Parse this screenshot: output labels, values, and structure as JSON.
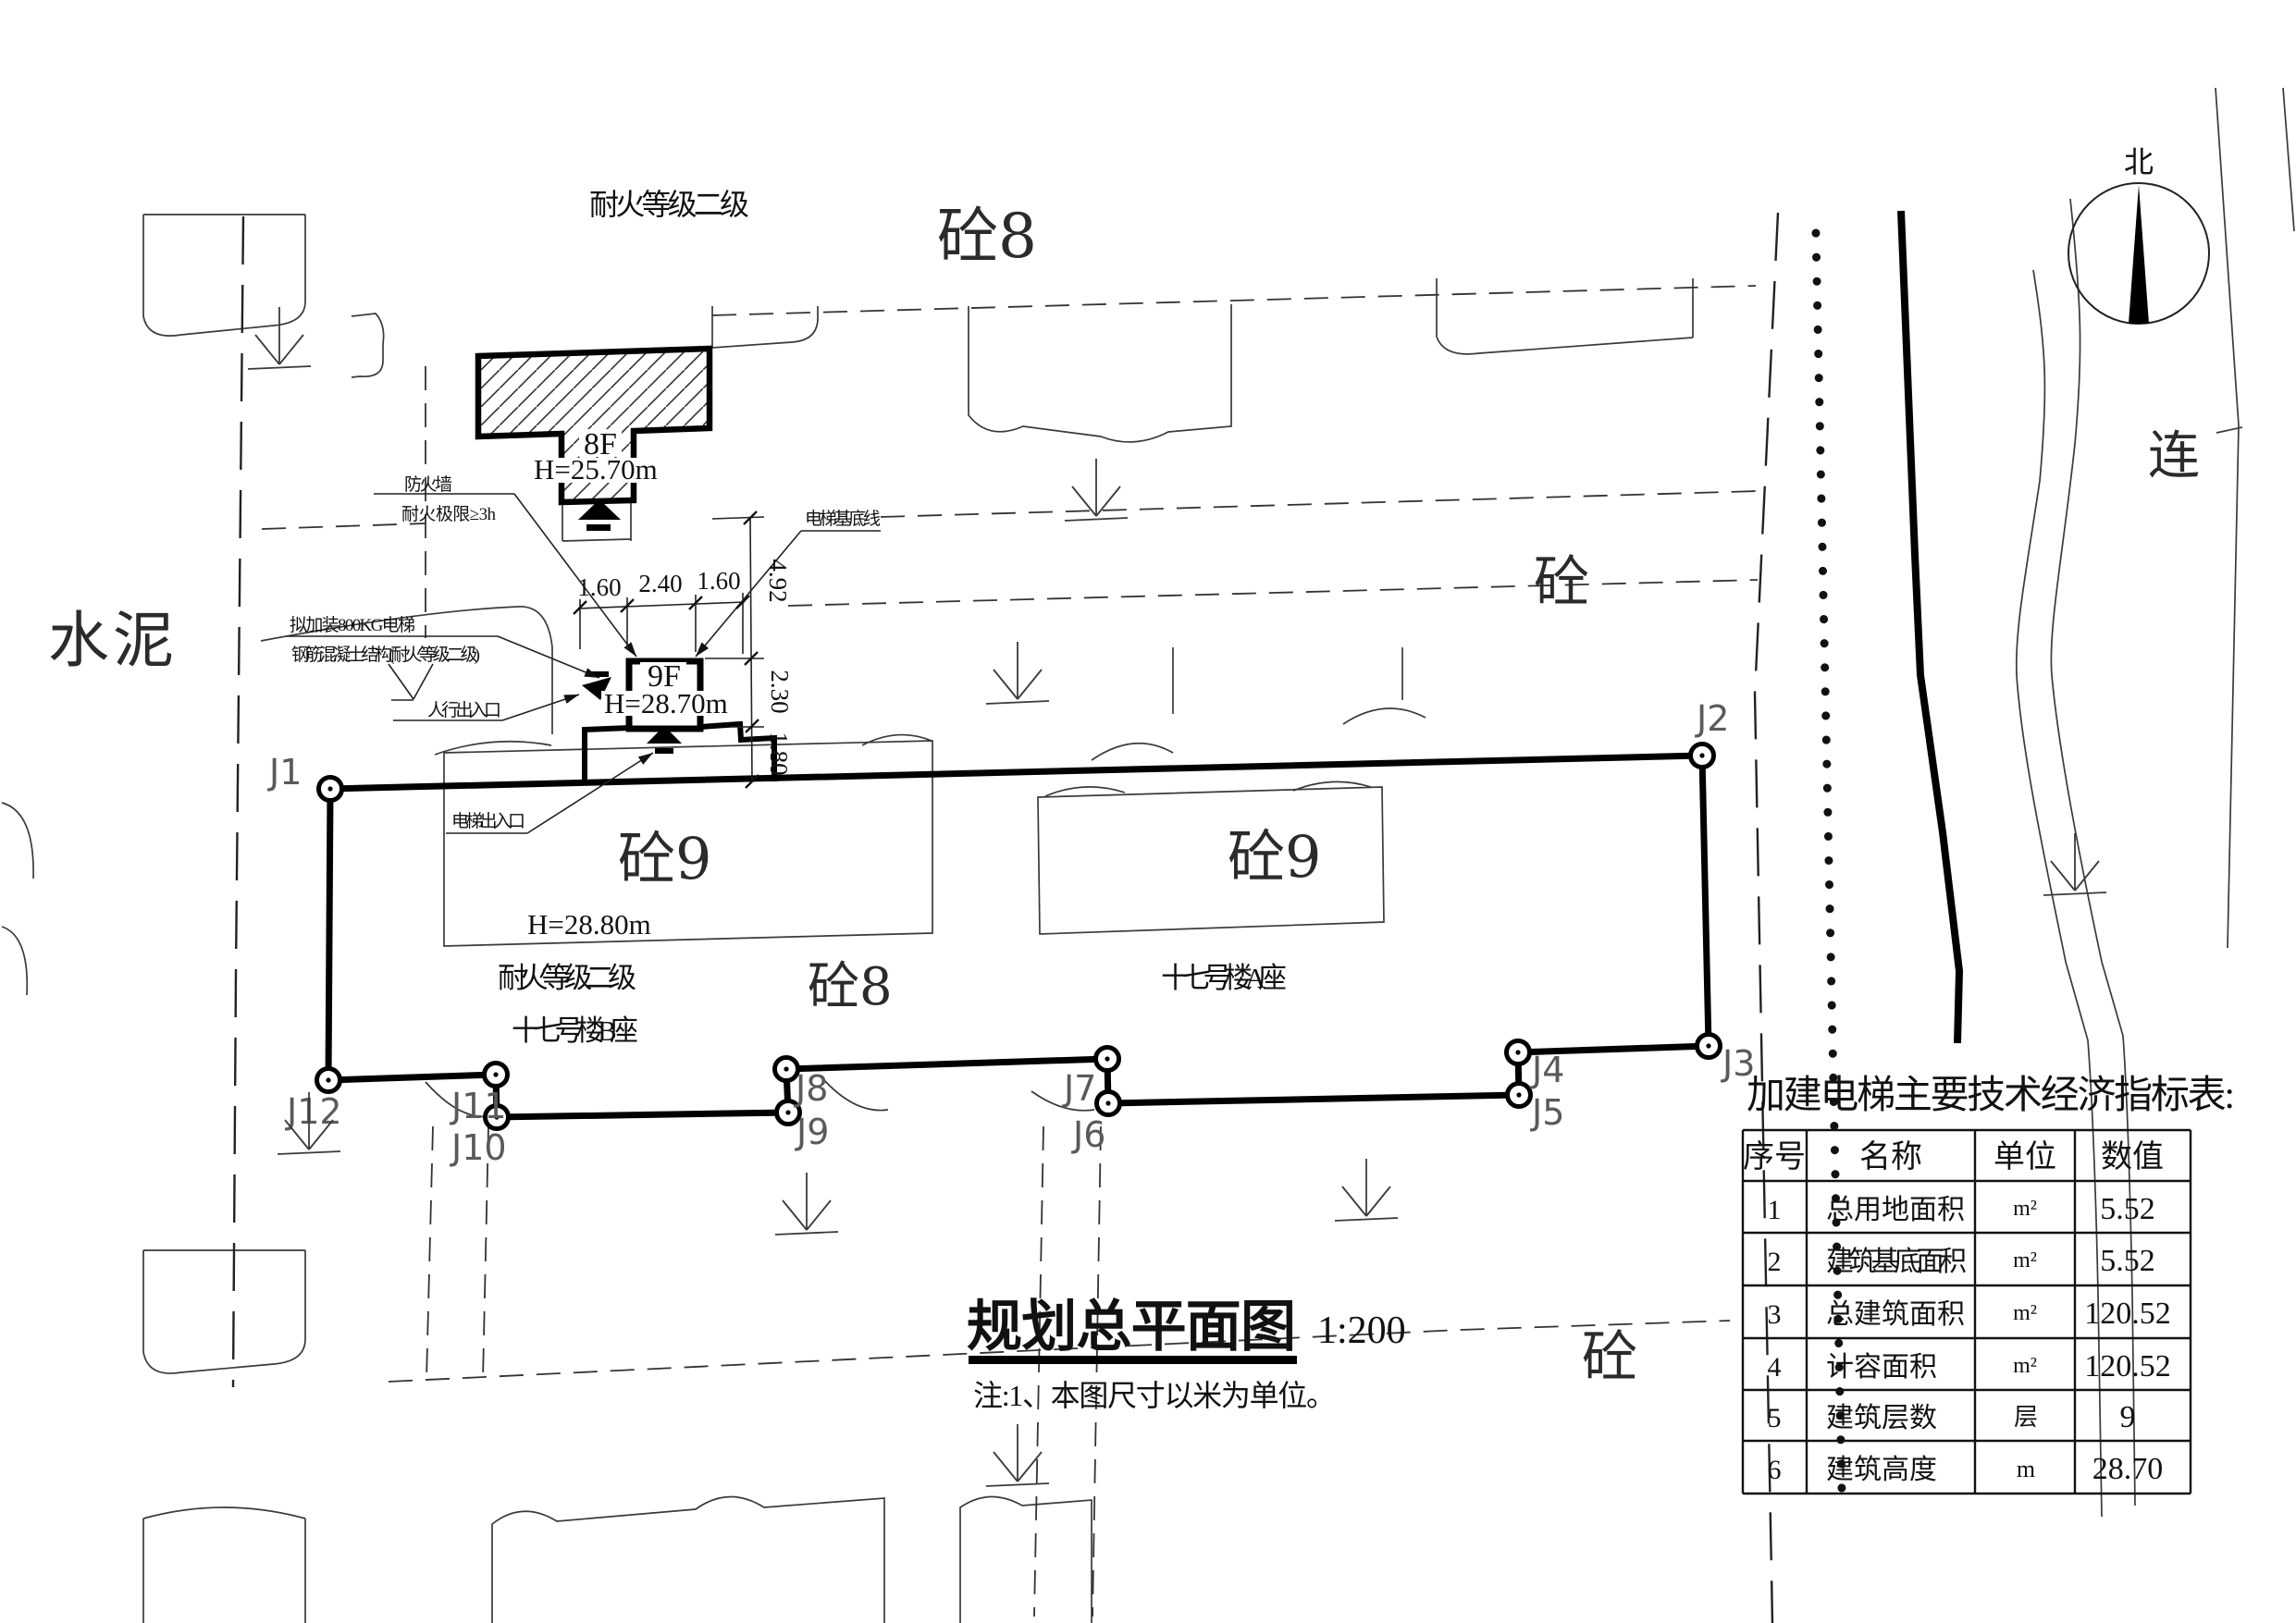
{
  "colors": {
    "ink": "#111111",
    "paper": "#ffffff",
    "gray": "#555555"
  },
  "site": {
    "fire_rating_top": "耐火等级二级",
    "concrete8_top": "砼8",
    "cement": "水泥",
    "road_name": "连",
    "north": "北",
    "concrete_right": "砼",
    "concrete_bottom": "砼",
    "concrete9_left": "砼9",
    "concrete9_right": "砼9",
    "concrete8_mid": "砼8"
  },
  "existing_building": {
    "floors": "8F",
    "height": "H=25.70m",
    "firewall": "防火墙",
    "fire_limit": "耐火极限≥3h"
  },
  "new_elevator": {
    "floors": "9F",
    "height": "H=28.70m",
    "proposed": "拟加装800KG电梯",
    "structure": "钢筋混凝土结构(耐火等级二级)",
    "ped_entrance": "人行出入口",
    "elevator_entrance": "电梯出入口",
    "base_line": "电梯基底线",
    "dims": {
      "w_left": "1.60",
      "w_mid": "2.40",
      "w_right": "1.60",
      "v_top": "4.92",
      "v_mid": "2.30",
      "v_bottom": "1.80"
    }
  },
  "building_b": {
    "height": "H=28.80m",
    "fire_rating": "耐火等级二级",
    "name": "十七号楼B座"
  },
  "building_a": {
    "name": "十七号楼A座"
  },
  "boundary_points": {
    "j1": "J1",
    "j2": "J2",
    "j3": "J3",
    "j4": "J4",
    "j5": "J5",
    "j6": "J6",
    "j7": "J7",
    "j8": "J8",
    "j9": "J9",
    "j10": "J10",
    "j11": "J11",
    "j12": "J12"
  },
  "title_block": {
    "title": "规划总平面图",
    "scale": "1:200",
    "note": "注:1、本图尺寸以米为单位。"
  },
  "indicator_table": {
    "title": "加建电梯主要技术经济指标表:",
    "headers": [
      "序号",
      "名称",
      "单位",
      "数值"
    ],
    "rows": [
      {
        "no": "1",
        "name": "总用地面积",
        "unit": "m²",
        "value": "5.52"
      },
      {
        "no": "2",
        "name": "建筑基底面积",
        "unit": "m²",
        "value": "5.52"
      },
      {
        "no": "3",
        "name": "总建筑面积",
        "unit": "m²",
        "value": "120.52"
      },
      {
        "no": "4",
        "name": "计容面积",
        "unit": "m²",
        "value": "120.52"
      },
      {
        "no": "5",
        "name": "建筑层数",
        "unit": "层",
        "value": "9"
      },
      {
        "no": "6",
        "name": "建筑高度",
        "unit": "m",
        "value": "28.70"
      }
    ]
  }
}
